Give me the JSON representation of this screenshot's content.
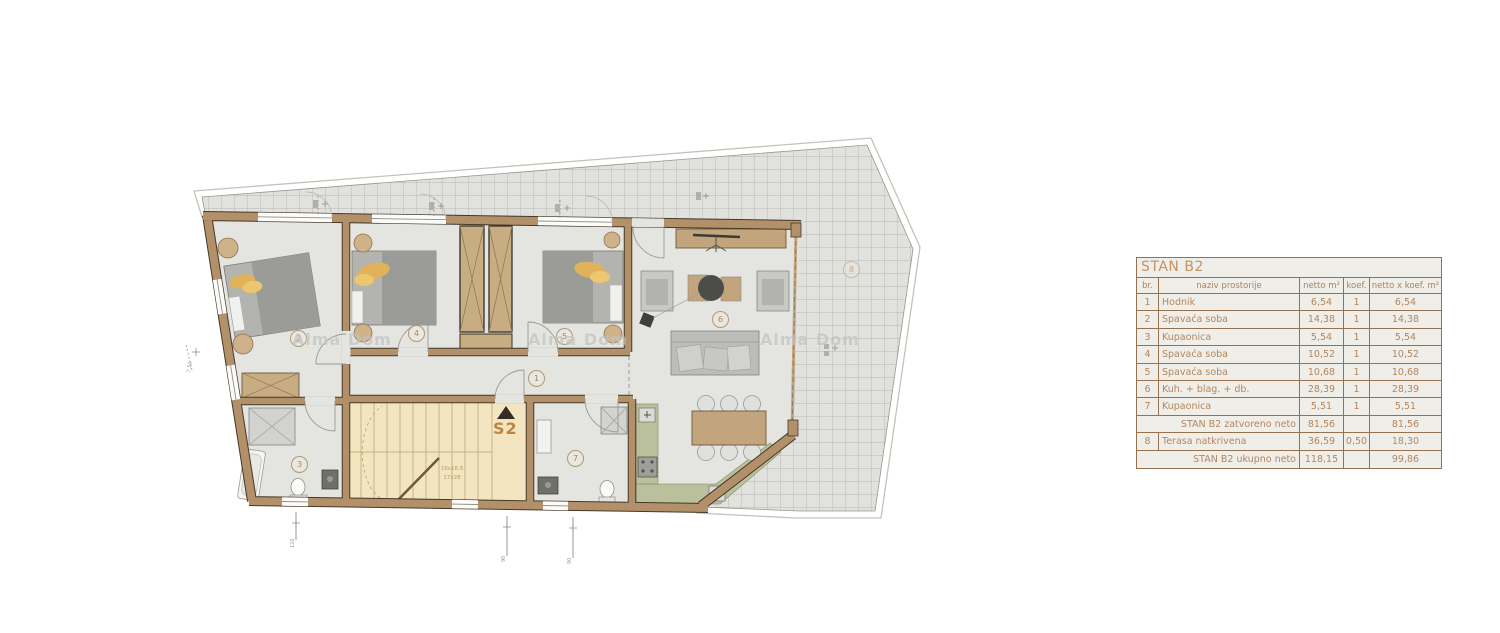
{
  "plan": {
    "rooms": [
      {
        "number": "1"
      },
      {
        "number": "2"
      },
      {
        "number": "3"
      },
      {
        "number": "4"
      },
      {
        "number": "5"
      },
      {
        "number": "6"
      },
      {
        "number": "7"
      },
      {
        "number": "8"
      }
    ],
    "stair_label": "S2",
    "stair_note_line1": "16x18,8",
    "stair_note_line2": "17x28",
    "watermark": "Alma Dom",
    "dims": {
      "left": "7,50",
      "bottom": [
        "120",
        "90",
        "90"
      ]
    }
  },
  "table": {
    "title": "STAN B2",
    "headers": {
      "br": "br.",
      "name": "naziv prostorije",
      "netto": "netto m²",
      "koef": "koef.",
      "total": "netto x koef. m²"
    },
    "rows": [
      {
        "br": "1",
        "name": "Hodnik",
        "netto": "6,54",
        "koef": "1",
        "total": "6,54"
      },
      {
        "br": "2",
        "name": "Spavaća soba",
        "netto": "14,38",
        "koef": "1",
        "total": "14,38"
      },
      {
        "br": "3",
        "name": "Kupaonica",
        "netto": "5,54",
        "koef": "1",
        "total": "5,54"
      },
      {
        "br": "4",
        "name": "Spavaća soba",
        "netto": "10,52",
        "koef": "1",
        "total": "10,52"
      },
      {
        "br": "5",
        "name": "Spavaća soba",
        "netto": "10,68",
        "koef": "1",
        "total": "10,68"
      },
      {
        "br": "6",
        "name": "Kuh. + blag. + db.",
        "netto": "28,39",
        "koef": "1",
        "total": "28,39"
      },
      {
        "br": "7",
        "name": "Kupaonica",
        "netto": "5,51",
        "koef": "1",
        "total": "5,51"
      },
      {
        "br": "",
        "name": "STAN B2 zatvoreno neto",
        "netto": "81,56",
        "koef": "",
        "total": "81,56"
      },
      {
        "br": "8",
        "name": "Terasa natkrivena",
        "netto": "36,59",
        "koef": "0,50",
        "total": "18,30"
      },
      {
        "br": "",
        "name": "STAN B2 ukupno neto",
        "netto": "118,15",
        "koef": "",
        "total": "99,86"
      }
    ]
  }
}
